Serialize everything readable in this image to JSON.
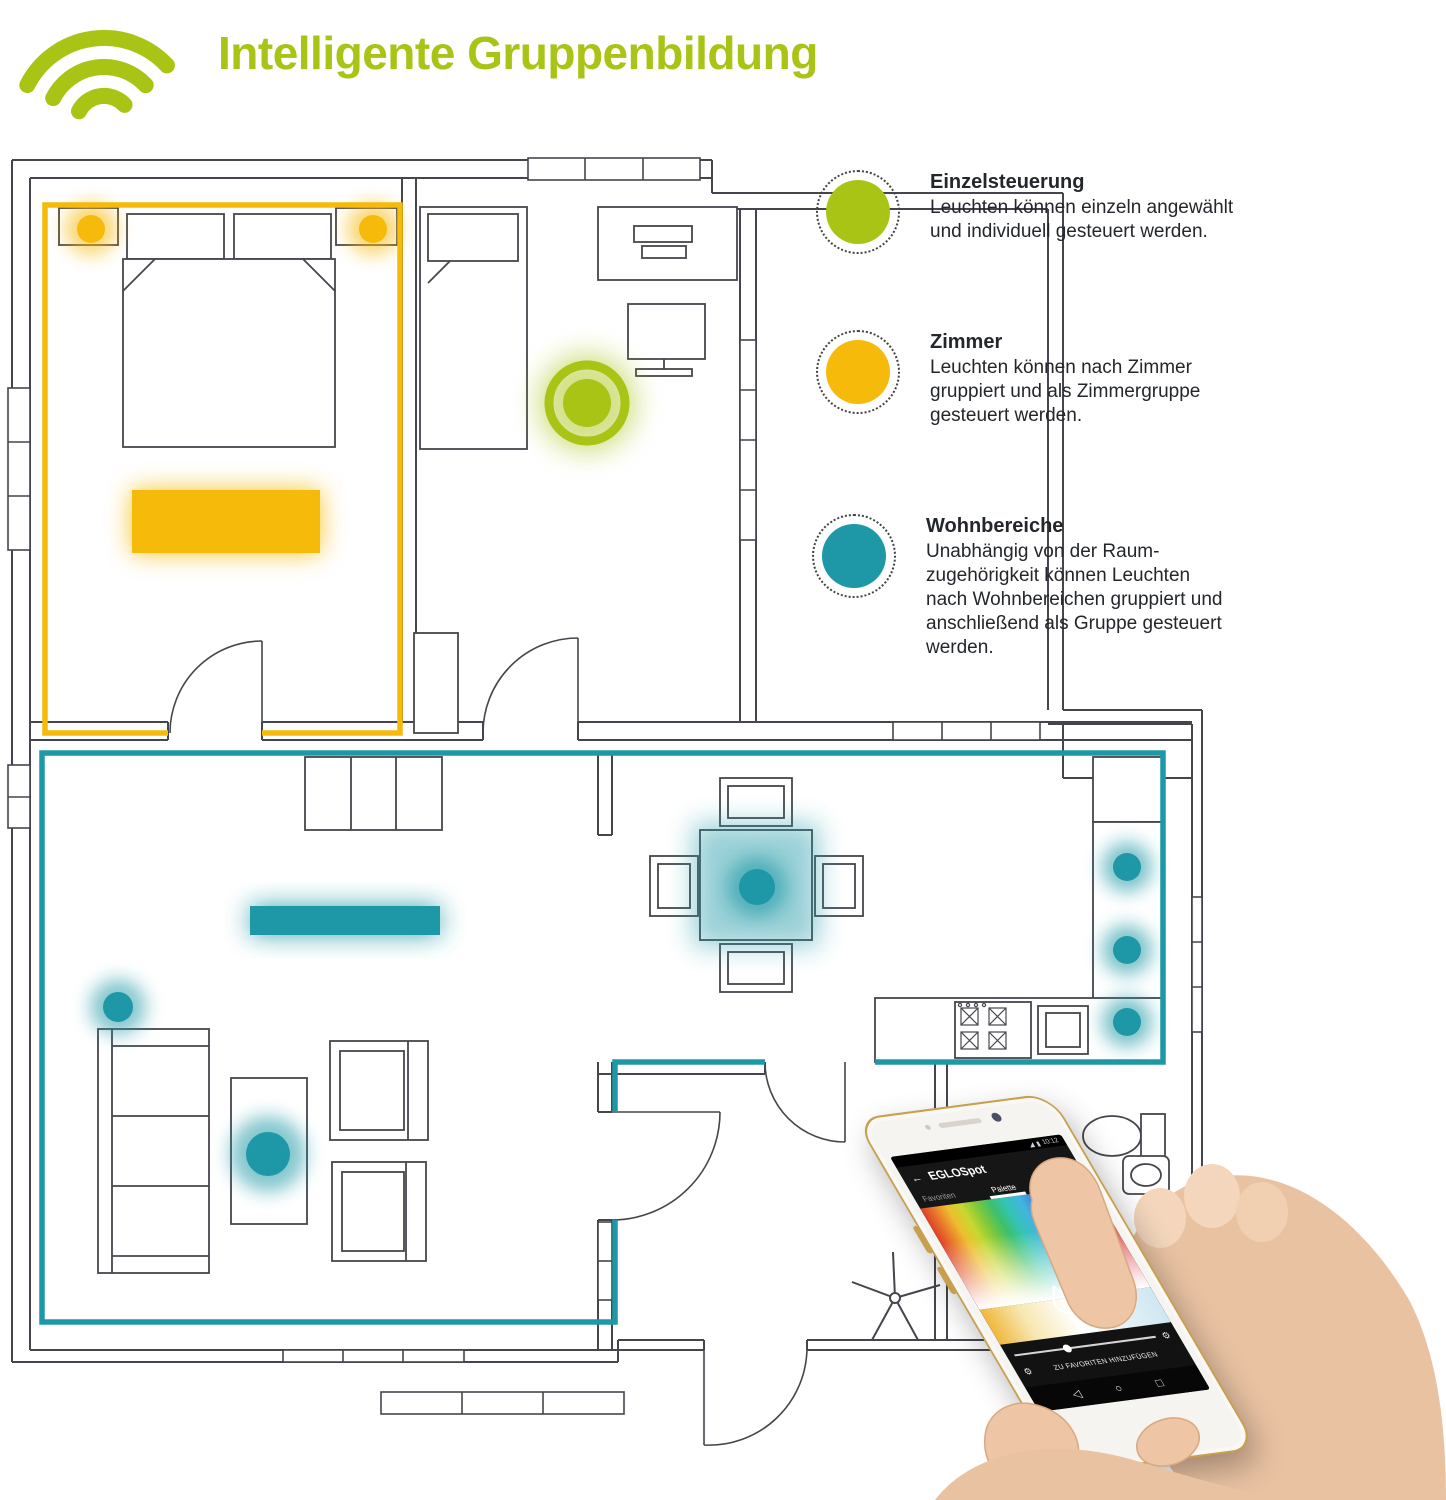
{
  "header": {
    "title": "Intelligente Gruppenbildung"
  },
  "legend": {
    "items": [
      {
        "id": "einzelsteuerung",
        "heading": "Einzelsteuerung",
        "body": "Leuchten können einzeln angewählt\nund individuell gesteuert werden.",
        "color": "#a9c414"
      },
      {
        "id": "zimmer",
        "heading": "Zimmer",
        "body": "Leuchten können nach Zimmer\ngruppiert und als Zimmergruppe\ngesteuert werden.",
        "color": "#f6ba0b"
      },
      {
        "id": "wohnbereiche",
        "heading": "Wohnbereiche",
        "body": "Unabhängig von der Raum-\nzugehörigkeit können Leuchten\nnach Wohnbereichen gruppiert und\nanschließend als Gruppe gesteuert\nwerden.",
        "color": "#1e98a6"
      }
    ]
  },
  "phone": {
    "status_time": "10:12",
    "status_icons": {
      "signal": "◢",
      "battery": "▮"
    },
    "back_icon": "←",
    "app_title": "EGLOSpot",
    "tabs": [
      {
        "label": "Favoriten",
        "active": false
      },
      {
        "label": "Palette",
        "active": true
      },
      {
        "label": "Szenen",
        "active": false
      }
    ],
    "favorite_action": "ZU FAVORITEN HINZUFÜGEN",
    "gear_icon": "⚙",
    "nav_icons": [
      "◁",
      "○",
      "□"
    ],
    "slider_position_pct": 35
  },
  "floor_plan": {
    "individual_light_count": 1,
    "zimmer_group": {
      "spots": 2,
      "light_bars": 1
    },
    "wohnbereich_group": {
      "spots": 6,
      "light_bars": 1
    }
  },
  "colors": {
    "green": "#a9c414",
    "yellow": "#f6ba0b",
    "teal": "#1e98a6",
    "wall": "#45454d",
    "text": "#23262b"
  }
}
